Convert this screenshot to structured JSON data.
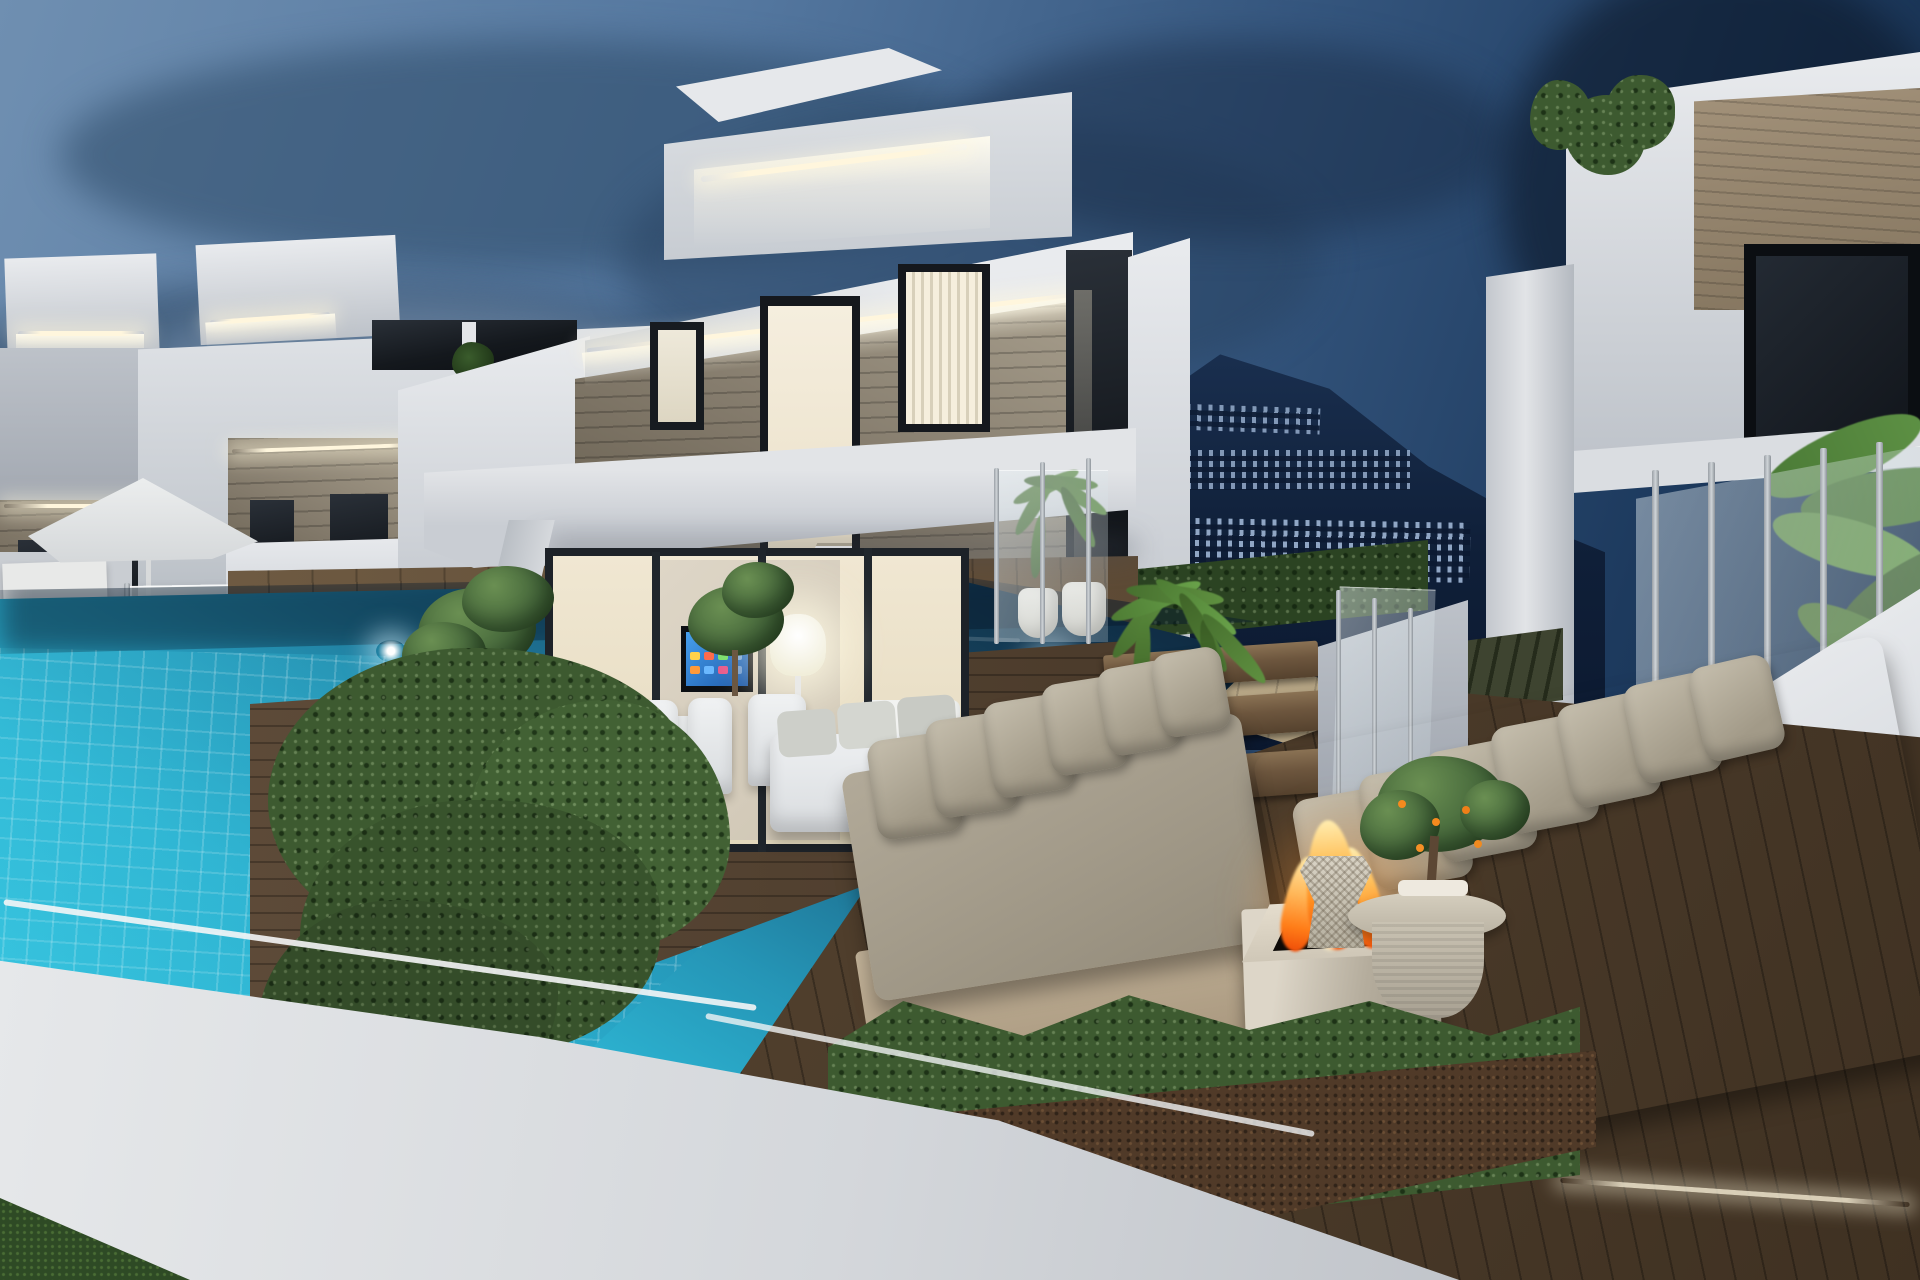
{
  "scene": {
    "description": "Twilight 3D architectural rendering of modern white villas with LED cove lighting, a stone-clad facade, an illuminated infinity pool, wooden deck lounge with grey sofas and a burning fire pit, glass balustrades, potted palms, a boxwood hedge, and a hillside town silhouette under a dusk sky.",
    "time_of_day": "dusk"
  },
  "palette": {
    "sky-top-left": "#6f8fb1",
    "sky-mid": "#54779f",
    "sky-dusk": "#35567e",
    "sky-right": "#1d3a5e",
    "sky-deep": "#13263f",
    "cloud-dark": "#2c4866",
    "cloud-light": "#93a9c0",
    "mountain": "#13233c",
    "town-light": "#a7bedd",
    "wall-lit": "#e9ebee",
    "wall-mid": "#d2d6db",
    "wall-dim": "#bdc2c9",
    "wall-shade": "#989ea8",
    "stone-lit": "#aba290",
    "stone-mid": "#847b6c",
    "stone-dark": "#5a5243",
    "led": "#fff6dd",
    "warm-interior": "#f3ead4",
    "window-dark": "#14181d",
    "pool-far": "#10293f",
    "pool-mid": "#1e7396",
    "pool-near": "#2fb9d6",
    "deck-light": "#c0ae8c",
    "deck-mid": "#6a573f",
    "deck-dark": "#483828",
    "hedge": "#3d5a30",
    "hedge-dark": "#2b4322",
    "sofa": "#a89f8e",
    "pillow": "#b8b1a0",
    "fire-core": "#ffe49a",
    "fire-mid": "#ff9e2e",
    "fire-deep": "#f1570c",
    "pot-beige": "#d7cdbb",
    "pot-white": "#eae7e0",
    "plant-green": "#4e7a3a",
    "tv-screen": "#2f80d8"
  },
  "objects": [
    "dusk sky with cloud bank",
    "hillside town silhouette",
    "left neighbouring villas with LED cove lighting",
    "main villa with stone-clad upper floor",
    "roof terrace box with cove light",
    "interior staircase behind tall glazing",
    "warm-lit bedroom windows with louvers",
    "covered terrace with angled column",
    "sliding glass doors with lit living room",
    "wall-mounted TV with blue smart-screen",
    "white glowing floor lamp",
    "white outdoor dining set",
    "white daybed with cushions",
    "infinity pool with tiled wall and underwater lights",
    "beige pool deck and dark lounge deck",
    "glass pool fence and patio umbrella",
    "two grey lounge sofas with pillow rows",
    "square concrete fire pit with flames",
    "round coffee table with citrus plant",
    "wicker stool",
    "potted palms and olive trees",
    "large boxwood hedge",
    "white boundary wall and lawn corner",
    "right neighbouring villa with glass balustrade and banana plant"
  ]
}
